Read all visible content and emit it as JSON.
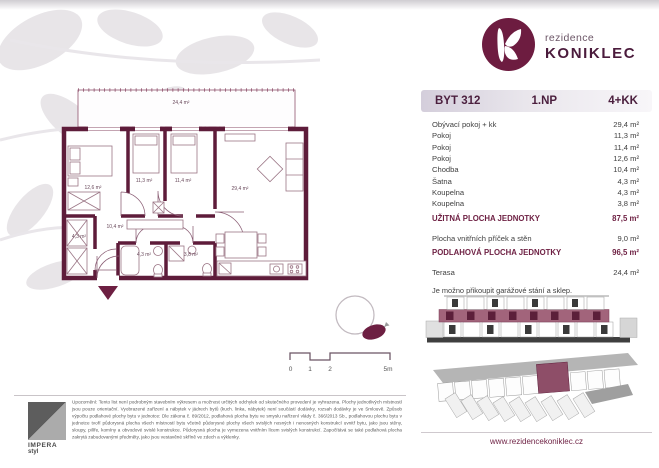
{
  "brand": {
    "prefix": "rezidence",
    "name": "KONIKLEC",
    "website": "www.rezidencekoniklec.cz",
    "color": "#6d1c40"
  },
  "header": {
    "unit": "BYT 312",
    "floor": "1.NP",
    "disposition": "4+KK"
  },
  "room_table": {
    "rows": [
      {
        "label": "Obývací pokoj + kk",
        "area": "29,4 m²"
      },
      {
        "label": "Pokoj",
        "area": "11,3 m²"
      },
      {
        "label": "Pokoj",
        "area": "11,4 m²"
      },
      {
        "label": "Pokoj",
        "area": "12,6 m²"
      },
      {
        "label": "Chodba",
        "area": "10,4 m²"
      },
      {
        "label": "Šatna",
        "area": "4,3 m²"
      },
      {
        "label": "Koupelna",
        "area": "4,3 m²"
      },
      {
        "label": "Koupelna",
        "area": "3,8 m²"
      }
    ]
  },
  "summary": {
    "usable": {
      "label": "UŽITNÁ PLOCHA JEDNOTKY",
      "area": "87,5 m²"
    },
    "partitions": {
      "label": "Plocha vnitřních příček a stěn",
      "area": "9,0 m²"
    },
    "floor_area": {
      "label": "PODLAHOVÁ PLOCHA JEDNOTKY",
      "area": "96,5 m²"
    },
    "terrace": {
      "label": "Terasa",
      "area": "24,4 m²"
    },
    "note": "Je možno přikoupit garážové stání a sklep."
  },
  "plan_labels": {
    "terrace": "24,4 m²",
    "living": "29,4 m²",
    "bedroom_1": "12,6 m²",
    "bedroom_2": "11,3 m²",
    "bedroom_3": "11,4 m²",
    "corridor": "10,4 m²",
    "wardrobe": "4,3 m²",
    "bath_1": "4,3 m²",
    "bath_2": "3,8 m²"
  },
  "scalebar": {
    "t0": "0",
    "t1": "1",
    "t2": "2",
    "t5": "5m"
  },
  "publisher": {
    "name": "IMPERA",
    "suffix": "styl"
  },
  "disclaimer": "Upozornění: Tento list není podrobným stavebním výkresem a možnost určitých odchylek od skutečného provedení je vyhrazena. Plochy jednotlivých místností jsou pouze orientační. Vyobrazené zařízení a nábytek v jádrech bytů (kuch. linka, nábytek) není součástí dodávky, rozsah dodávky je ve Smlouvě. Způsob výpočtu podlahové plochy bytu v jednotce: Dle zákona č. 89/2012, podlahová plocha bytu ve smyslu nařízení vlády č. 366/2013 Sb., podlahovou plochu bytu v jednotce tvoří půdorysná plocha všech místností bytu včetně půdorysné plochy všech svislých nosných i nenosných konstrukcí uvnitř bytu, jako jsou stěny, sloupy, pilíře, komíny a obvodové svislé konstrukce. Půdorysná plocha je vymezena vnitřním lícem svislých konstrukcí. Započítává se také podlahová plocha zakrytá zabudovanými předměty, jako jsou vestavěné skříně ve zdech a výklenky."
}
